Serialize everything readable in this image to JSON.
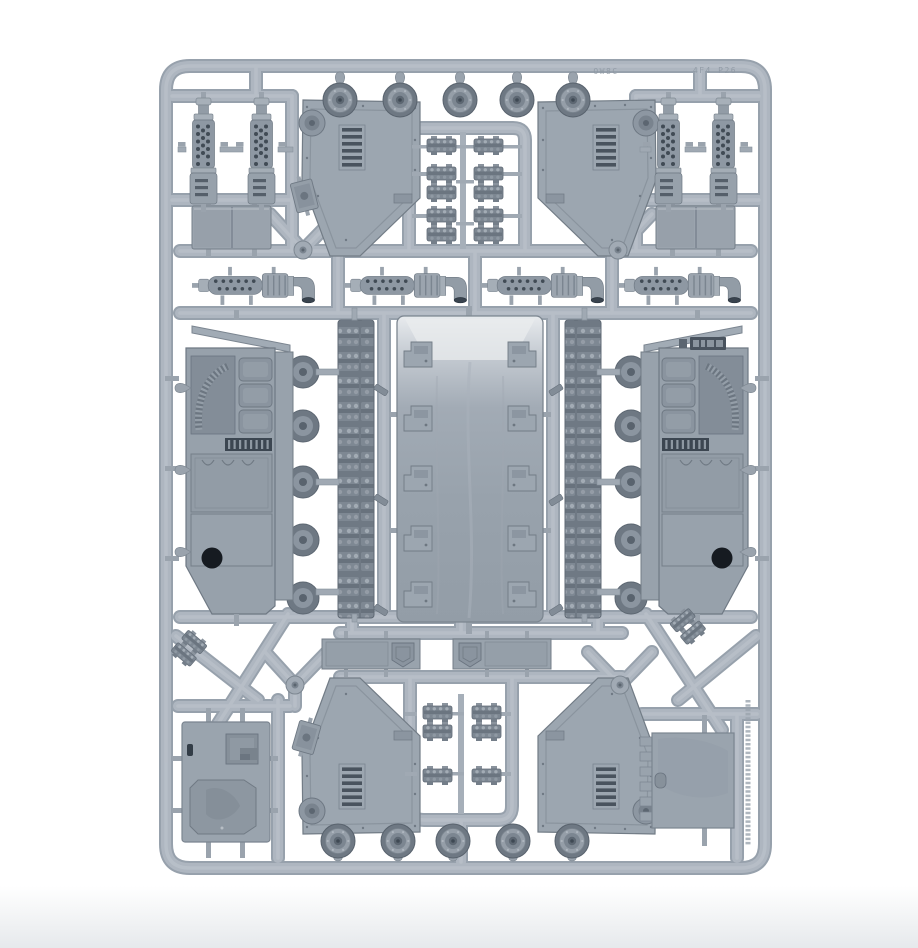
{
  "scene": {
    "description": "Photograph of a light grey plastic model kit sprue (injection-moulded frame) holding unassembled armoured-vehicle parts, on a plain white background",
    "background_color": "#ffffff",
    "floor_shadow_color": "#e7eaec"
  },
  "sprue": {
    "plastic_base_color": "#aab3bd",
    "plastic_highlight_color": "#c3cad1",
    "plastic_shadow_color": "#8b95a0",
    "dark_recess_color": "#414b55",
    "embossed_code_top_left": "OW8C",
    "embossed_code_top_right": "4F4 P26"
  },
  "parts_inventory": {
    "exhaust_stacks_vertical": 4,
    "exhaust_pipes_horizontal": 4,
    "vented_side_armor_plates": 4,
    "hull_side_panels": 2,
    "track_runs": 2,
    "hull_floor_panel": 1,
    "road_wheels": 10,
    "track_link_plates": 10,
    "stowage_box_panels": 2,
    "door_hatch_panels": 2,
    "glacis_hatch_plates": 2,
    "short_track_sections": 2,
    "small_fittings": 8
  }
}
